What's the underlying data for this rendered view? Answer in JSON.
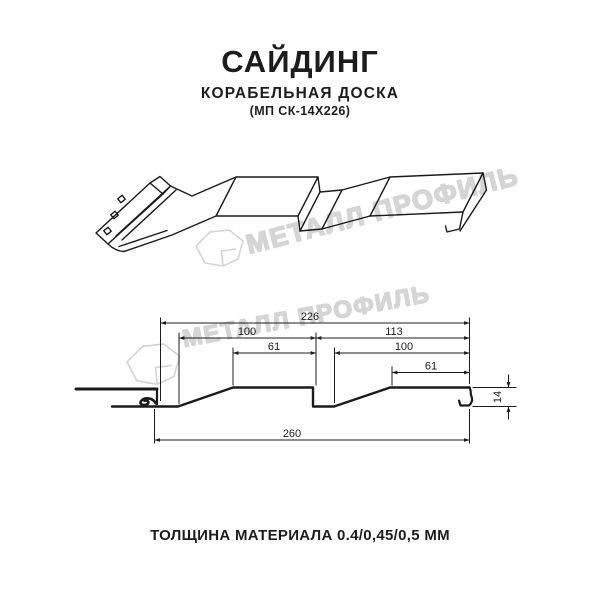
{
  "header": {
    "title": "САЙДИНГ",
    "subtitle": "КОРАБЕЛЬНАЯ ДОСКА",
    "code": "(МП СК-14Х226)"
  },
  "watermark": {
    "brand": "МЕТАЛЛ ПРОФИЛЬ",
    "color": "#d5d5d5",
    "logo_icon": "metall-profil-house-logo"
  },
  "section": {
    "dimensions": {
      "total_top": "226",
      "board1_bottom": "100",
      "board1_top": "61",
      "board2_total": "113",
      "board2_bottom": "100",
      "board2_top": "61",
      "overall_width": "260",
      "profile_height": "14"
    }
  },
  "footer": {
    "thickness": "ТОЛЩИНА МАТЕРИАЛА 0.4/0,45/0,5 ММ"
  },
  "colors": {
    "line": "#1a1a1a",
    "text": "#1d1d1d",
    "watermark": "#d5d5d5"
  }
}
